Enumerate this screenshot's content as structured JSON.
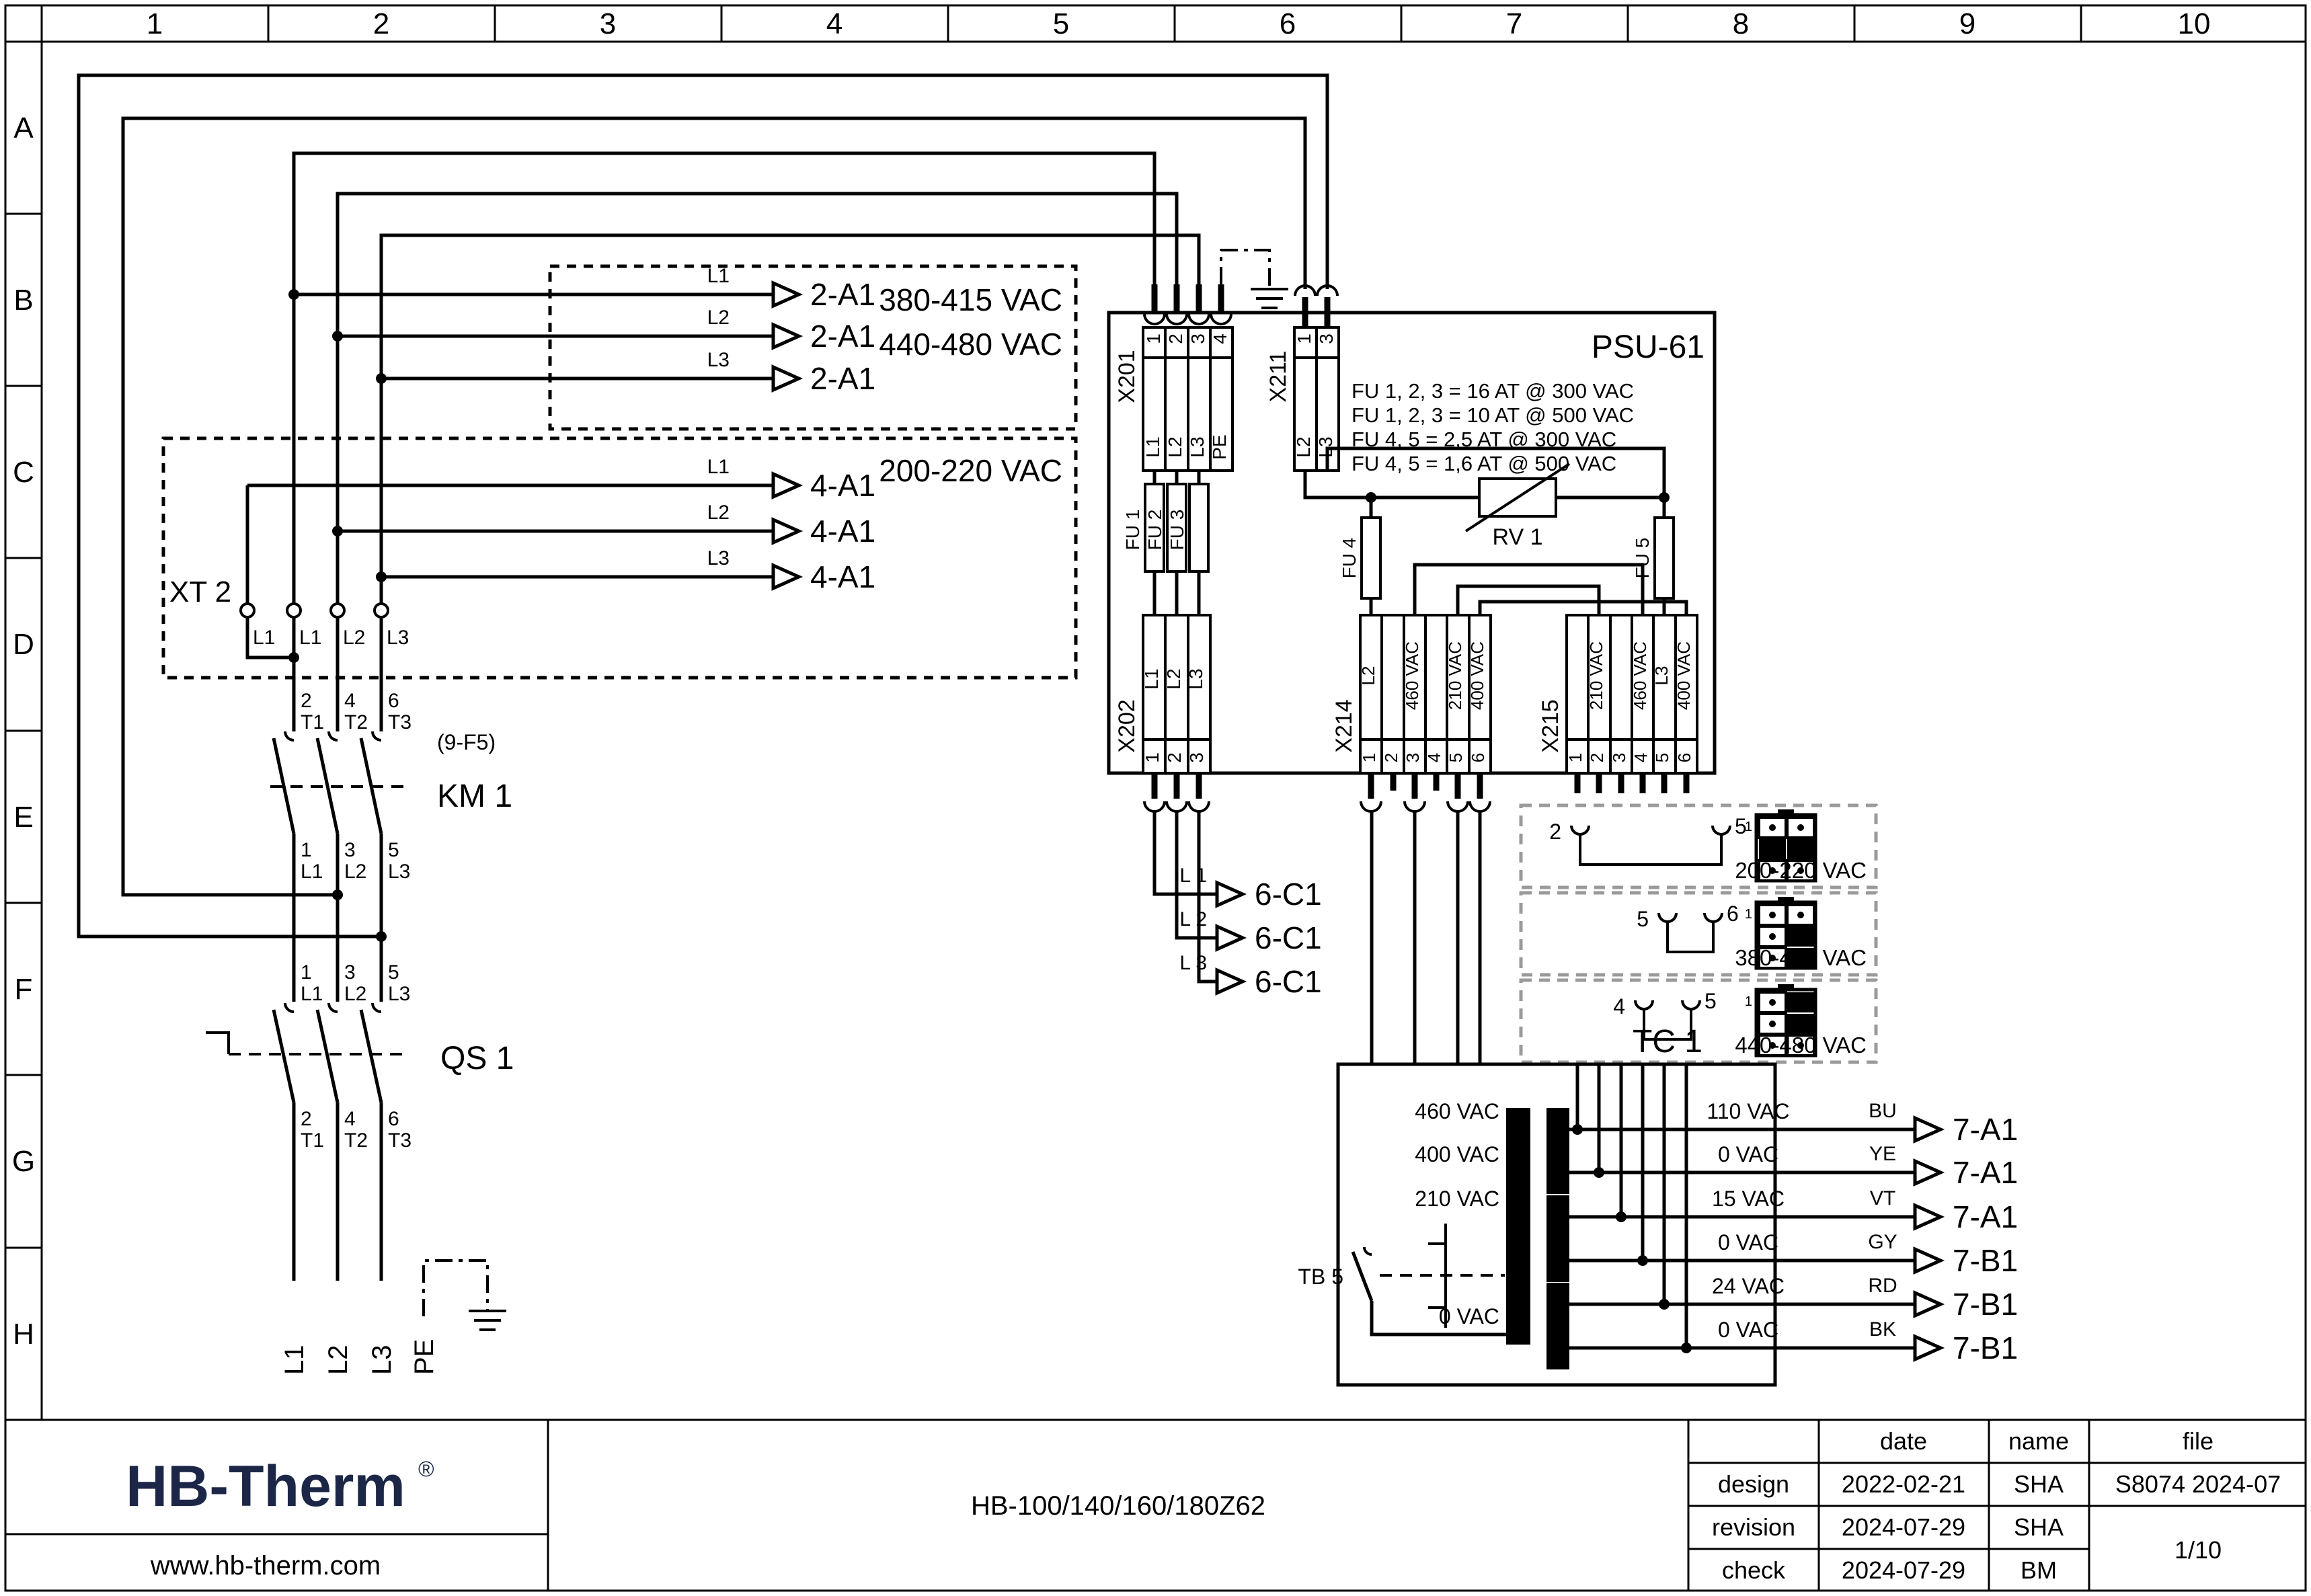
{
  "ruler": {
    "cols": [
      "1",
      "2",
      "3",
      "4",
      "5",
      "6",
      "7",
      "8",
      "9",
      "10"
    ],
    "rows": [
      "A",
      "B",
      "C",
      "D",
      "E",
      "F",
      "G",
      "H"
    ]
  },
  "feeds_hv": {
    "range1": "380-415 VAC",
    "range2": "440-480 VAC",
    "lines": [
      {
        "phase": "L1",
        "dest": "2-A1"
      },
      {
        "phase": "L2",
        "dest": "2-A1"
      },
      {
        "phase": "L3",
        "dest": "2-A1"
      }
    ]
  },
  "feeds_lv": {
    "range": "200-220 VAC",
    "lines": [
      {
        "phase": "L1",
        "dest": "4-A1"
      },
      {
        "phase": "L2",
        "dest": "4-A1"
      },
      {
        "phase": "L3",
        "dest": "4-A1"
      }
    ]
  },
  "xt2": {
    "name": "XT 2",
    "terminals": [
      "L1",
      "L1",
      "L2",
      "L3"
    ]
  },
  "km1": {
    "ref": "(9-F5)",
    "name": "KM 1",
    "top_pins": [
      "2",
      "4",
      "6"
    ],
    "top_labels": [
      "T1",
      "T2",
      "T3"
    ],
    "bottom_pins": [
      "1",
      "3",
      "5"
    ],
    "bottom_labels": [
      "L1",
      "L2",
      "L3"
    ]
  },
  "qs1": {
    "name": "QS 1",
    "top_pins": [
      "1",
      "3",
      "5"
    ],
    "top_labels": [
      "L1",
      "L2",
      "L3"
    ],
    "bottom_pins": [
      "2",
      "4",
      "6"
    ],
    "bottom_labels": [
      "T1",
      "T2",
      "T3"
    ]
  },
  "mains": [
    "L1",
    "L2",
    "L3",
    "PE"
  ],
  "psu": {
    "name": "PSU-61",
    "fuse_notes": [
      "FU 1, 2, 3 = 16 AT @ 300 VAC",
      "FU 1, 2, 3 = 10 AT @ 500 VAC",
      "FU 4, 5 = 2,5 AT @ 300 VAC",
      "FU 4, 5 = 1,6 AT @ 500 VAC"
    ],
    "x201": {
      "name": "X201",
      "pins": [
        "1",
        "2",
        "3",
        "4"
      ],
      "labels": [
        "L1",
        "L2",
        "L3",
        "PE"
      ]
    },
    "x211": {
      "name": "X211",
      "pins": [
        "1",
        "3"
      ],
      "labels": [
        "L2",
        "L3"
      ]
    },
    "x202": {
      "name": "X202",
      "pins": [
        "1",
        "2",
        "3"
      ],
      "labels": [
        "L1",
        "L2",
        "L3"
      ]
    },
    "x214": {
      "name": "X214",
      "pins": [
        "1",
        "2",
        "3",
        "4",
        "5",
        "6"
      ],
      "labels": [
        "L2",
        "",
        "460 VAC",
        "",
        "210 VAC",
        "400 VAC"
      ]
    },
    "x215": {
      "name": "X215",
      "pins": [
        "1",
        "2",
        "3",
        "4",
        "5",
        "6"
      ],
      "labels": [
        "",
        "210 VAC",
        "",
        "460 VAC",
        "L3",
        "400 VAC"
      ]
    },
    "fuses": [
      "FU 1",
      "FU 2",
      "FU 3",
      "FU 4",
      "FU 5"
    ],
    "rv1": "RV 1"
  },
  "out6": {
    "lines": [
      {
        "phase": "L 1",
        "dest": "6-C1"
      },
      {
        "phase": "L 2",
        "dest": "6-C1"
      },
      {
        "phase": "L 3",
        "dest": "6-C1"
      }
    ]
  },
  "selectors": [
    {
      "left_pin": "2",
      "right_pin": "5",
      "plug_pin": "1",
      "label": "200-220 VAC"
    },
    {
      "left_pin": "5",
      "right_pin": "6",
      "plug_pin": "1",
      "label": "380-415 VAC"
    },
    {
      "left_pin": "4",
      "right_pin": "5",
      "plug_pin": "1",
      "label": "440-480 VAC"
    }
  ],
  "tc1": {
    "name": "TC 1",
    "tb5": "TB 5",
    "primary": [
      "460 VAC",
      "400 VAC",
      "210 VAC",
      "0 VAC"
    ],
    "secondary": [
      "110 VAC",
      "0 VAC",
      "15 VAC",
      "0 VAC",
      "24 VAC",
      "0 VAC"
    ],
    "outputs": [
      {
        "color": "BU",
        "dest": "7-A1"
      },
      {
        "color": "YE",
        "dest": "7-A1"
      },
      {
        "color": "VT",
        "dest": "7-A1"
      },
      {
        "color": "GY",
        "dest": "7-B1"
      },
      {
        "color": "RD",
        "dest": "7-B1"
      },
      {
        "color": "BK",
        "dest": "7-B1"
      }
    ]
  },
  "titleblock": {
    "logo": "HB-Therm",
    "reg": "®",
    "url": "www.hb-therm.com",
    "model": "HB-100/140/160/180Z62",
    "col_date": "date",
    "col_name": "name",
    "col_file": "file",
    "rows": [
      {
        "label": "design",
        "date": "2022-02-21",
        "name": "SHA"
      },
      {
        "label": "revision",
        "date": "2024-07-29",
        "name": "SHA"
      },
      {
        "label": "check",
        "date": "2024-07-29",
        "name": "BM"
      }
    ],
    "file_no": "S8074 2024-07",
    "page": "1/10"
  },
  "colors": {
    "ink": "#000000",
    "logo_navy": "#1c2747",
    "selector_gray": "#9a9a9a"
  }
}
